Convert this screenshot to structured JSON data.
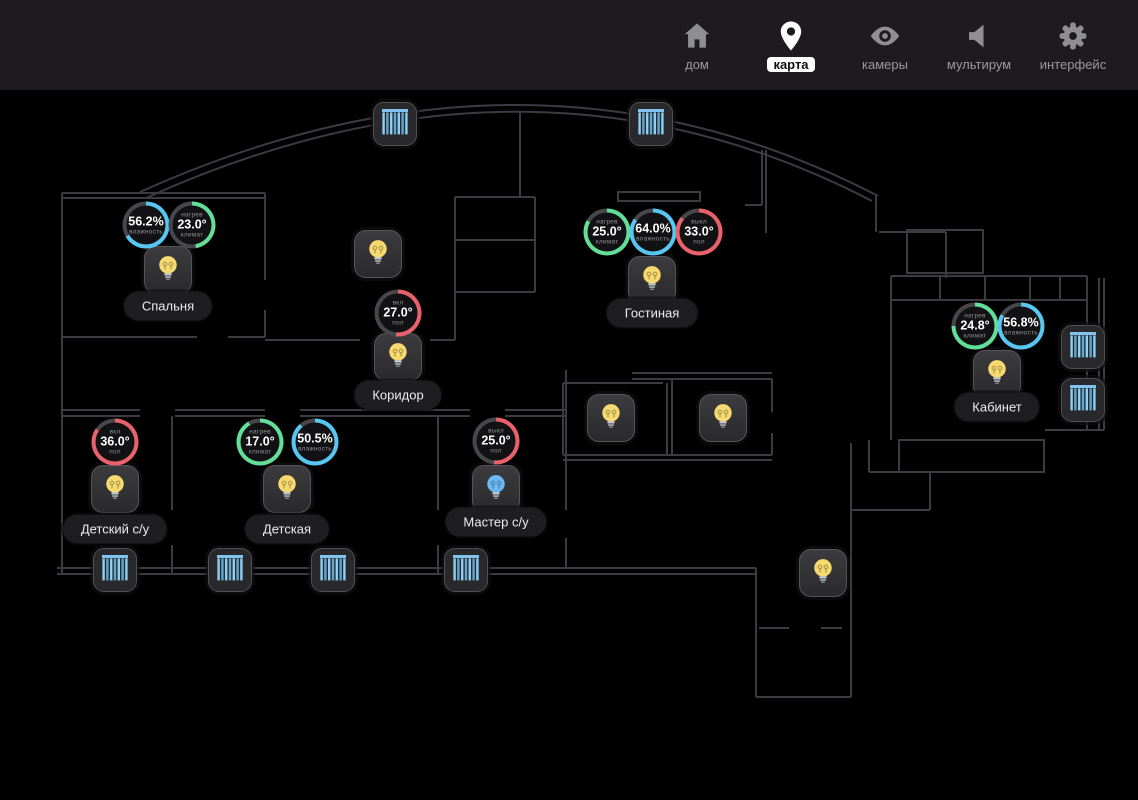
{
  "nav": {
    "items": [
      {
        "id": "home",
        "label": "дом",
        "icon": "home-icon",
        "active": false
      },
      {
        "id": "map",
        "label": "карта",
        "icon": "map-pin-icon",
        "active": true
      },
      {
        "id": "cameras",
        "label": "камеры",
        "icon": "eye-icon",
        "active": false
      },
      {
        "id": "multiroom",
        "label": "мультирум",
        "icon": "speaker-icon",
        "active": false
      },
      {
        "id": "interface",
        "label": "интерфейс",
        "icon": "gear-icon",
        "active": false
      }
    ]
  },
  "floorplan": {
    "colors": {
      "climate_green": "#63de99",
      "humidity_cyan": "#57c7f2",
      "floor_red": "#e8616b",
      "ring_gray": "#46464b",
      "bulb_yellow": "#f6d96f",
      "bulb_blue": "#6cb8f5",
      "blind_blue": "#7fc3ee"
    },
    "room_labels": [
      {
        "name": "Спальня",
        "x": 168,
        "y": 216
      },
      {
        "name": "Гостиная",
        "x": 652,
        "y": 223
      },
      {
        "name": "Коридор",
        "x": 398,
        "y": 305
      },
      {
        "name": "Детский с/у",
        "x": 115,
        "y": 439
      },
      {
        "name": "Детская",
        "x": 287,
        "y": 439
      },
      {
        "name": "Мастер с/у",
        "x": 496,
        "y": 432
      },
      {
        "name": "Кабинет",
        "x": 997,
        "y": 317
      }
    ],
    "gauges": [
      {
        "room": "Спальня",
        "top": "",
        "value": "56.2%",
        "bottom": "влажность",
        "kind": "humidity",
        "arc_deg": 240,
        "x": 146,
        "y": 135
      },
      {
        "room": "Спальня",
        "top": "нагрев",
        "value": "23.0°",
        "bottom": "климат",
        "kind": "climate",
        "arc_deg": 170,
        "x": 192,
        "y": 135
      },
      {
        "room": "Гостиная",
        "top": "нагрев",
        "value": "25.0°",
        "bottom": "климат",
        "kind": "climate",
        "arc_deg": 300,
        "x": 607,
        "y": 142
      },
      {
        "room": "Гостиная",
        "top": "",
        "value": "64.0%",
        "bottom": "влажность",
        "kind": "humidity",
        "arc_deg": 305,
        "x": 653,
        "y": 142
      },
      {
        "room": "Гостиная",
        "top": "выкл",
        "value": "33.0°",
        "bottom": "пол",
        "kind": "floor",
        "arc_deg": 310,
        "x": 699,
        "y": 142
      },
      {
        "room": "Коридор",
        "top": "вкл",
        "value": "27.0°",
        "bottom": "пол",
        "kind": "floor",
        "arc_deg": 185,
        "x": 398,
        "y": 223
      },
      {
        "room": "Кабинет",
        "top": "нагрев",
        "value": "24.8°",
        "bottom": "климат",
        "kind": "climate",
        "arc_deg": 270,
        "x": 975,
        "y": 236
      },
      {
        "room": "Кабинет",
        "top": "",
        "value": "56.8%",
        "bottom": "влажность",
        "kind": "humidity",
        "arc_deg": 300,
        "x": 1021,
        "y": 236
      },
      {
        "room": "Детский с/у",
        "top": "вкл",
        "value": "36.0°",
        "bottom": "пол",
        "kind": "floor",
        "arc_deg": 305,
        "x": 115,
        "y": 352
      },
      {
        "room": "Детская",
        "top": "нагрев",
        "value": "17.0°",
        "bottom": "климат",
        "kind": "climate",
        "arc_deg": 330,
        "x": 260,
        "y": 352
      },
      {
        "room": "Детская",
        "top": "",
        "value": "50.5%",
        "bottom": "влажность",
        "kind": "humidity",
        "arc_deg": 320,
        "x": 315,
        "y": 352
      },
      {
        "room": "Мастер с/у",
        "top": "выкл",
        "value": "25.0°",
        "bottom": "пол",
        "kind": "floor",
        "arc_deg": 185,
        "x": 496,
        "y": 351
      }
    ],
    "bulbs": [
      {
        "room": "Спальня",
        "x": 168,
        "y": 180,
        "state": "yellow"
      },
      {
        "room": "Коридор",
        "x": 378,
        "y": 164,
        "state": "yellow"
      },
      {
        "room": "Коридор",
        "x": 398,
        "y": 267,
        "state": "yellow"
      },
      {
        "room": "Гостиная",
        "x": 652,
        "y": 190,
        "state": "yellow"
      },
      {
        "room": "Гардероб-1",
        "x": 611,
        "y": 328,
        "state": "yellow"
      },
      {
        "room": "Гардероб-2",
        "x": 723,
        "y": 328,
        "state": "yellow"
      },
      {
        "room": "Детский с/у",
        "x": 115,
        "y": 399,
        "state": "yellow"
      },
      {
        "room": "Детская",
        "x": 287,
        "y": 399,
        "state": "yellow"
      },
      {
        "room": "Мастер с/у",
        "x": 496,
        "y": 399,
        "state": "blue"
      },
      {
        "room": "Кабинет",
        "x": 997,
        "y": 284,
        "state": "yellow"
      },
      {
        "room": "Прихожая",
        "x": 823,
        "y": 483,
        "state": "yellow"
      }
    ],
    "blinds": [
      {
        "x": 395,
        "y": 34
      },
      {
        "x": 651,
        "y": 34
      },
      {
        "x": 115,
        "y": 480
      },
      {
        "x": 230,
        "y": 480
      },
      {
        "x": 333,
        "y": 480
      },
      {
        "x": 466,
        "y": 480
      },
      {
        "x": 1083,
        "y": 257
      },
      {
        "x": 1083,
        "y": 310
      }
    ]
  }
}
